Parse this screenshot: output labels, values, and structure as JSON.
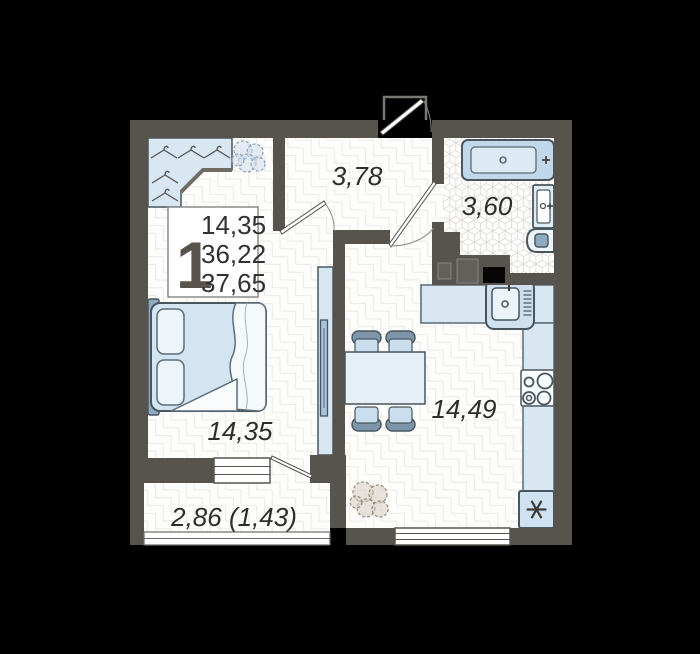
{
  "info": {
    "count": "1",
    "line1": "14,35",
    "line2": "36,22",
    "line3": "37,65"
  },
  "rooms": {
    "hallway": "3,78",
    "bathroom": "3,60",
    "bedroom": "14,35",
    "kitchen": "14,49",
    "balcony": "2,86 (1,43)"
  },
  "icons": {
    "hanger": "hanger-icon",
    "plant": "plant-icon",
    "bathtub": "bathtub-icon",
    "washbasin": "washbasin-icon",
    "toilet": "toilet-icon",
    "kitchen_sink": "kitchen-sink-icon",
    "stove": "stove-icon",
    "snowflake": "snowflake-icon",
    "tv": "tv-icon",
    "bed": "bed-icon",
    "dining_table": "dining-table-icon",
    "chair": "chair-icon",
    "door": "door-leaf-icon",
    "window": "window-icon"
  },
  "colors": {
    "background": "#000000",
    "wall": "#57544e",
    "floor": "#fdfdfc",
    "furniture_fill": "#d9e7f3",
    "furniture_accent": "#8fabc2",
    "outline": "#47565f",
    "text": "#2d2d2d",
    "tile_stroke": "#d5d1cd"
  }
}
